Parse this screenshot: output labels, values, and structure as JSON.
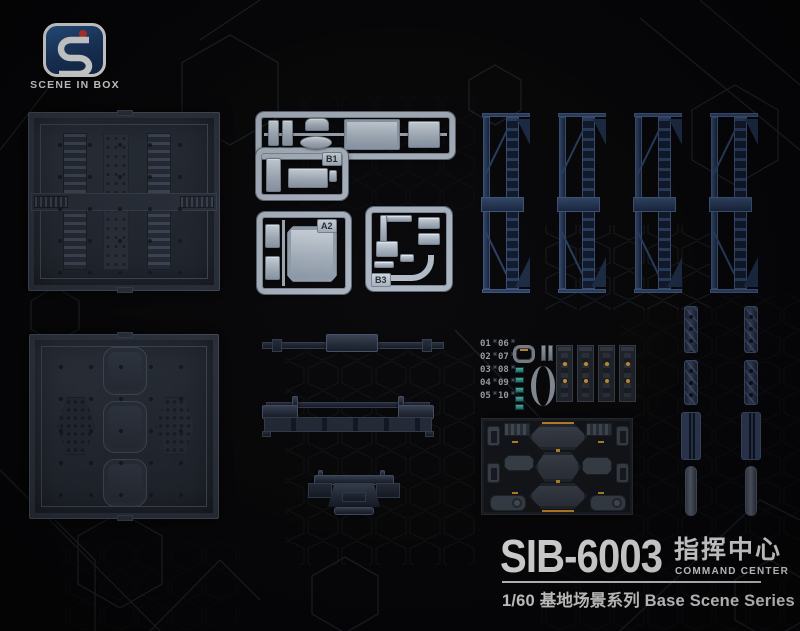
{
  "brand": {
    "wordmark": "SCENE IN BOX"
  },
  "product": {
    "code": "SIB-6003",
    "title_cn": "指挥中心",
    "title_en": "COMMAND CENTER",
    "series_line": "1/60 基地场景系列 Base Scene Series"
  },
  "runners": {
    "b1": "B1",
    "a2": "A2",
    "b3": "B3"
  },
  "marking_sheet": {
    "numbers": [
      "01",
      "06",
      "02",
      "07",
      "03",
      "08",
      "04",
      "09",
      "05",
      "10"
    ]
  },
  "colors": {
    "background": "#060608",
    "pillar_navy": "#2c4063",
    "sprue_gray": "#aeb8c4",
    "accent_amber": "#c58a26",
    "chip_teal": "#2f8e8a",
    "logo_blue": "#1c3a66",
    "logo_red": "#cf3b31",
    "title_white": "#f4f4f4"
  }
}
